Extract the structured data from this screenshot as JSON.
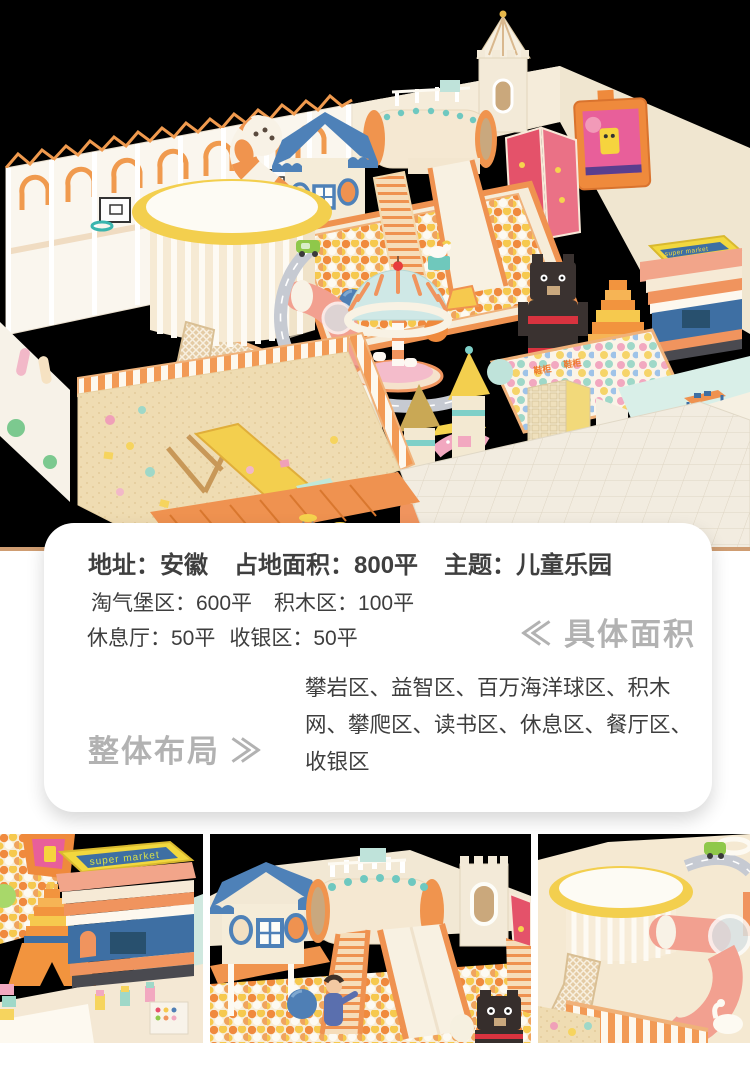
{
  "scene": {
    "background": "#000000",
    "signs": {
      "super_market": "super market",
      "shoe_cabinet_1": "鞋柜",
      "shoe_cabinet_2": "鞋柜",
      "cashier_desk": "收银台"
    },
    "palette": {
      "floor_cream": "#f6e8d0",
      "accent_orange": "#ef9250",
      "ball_orange": "#f08a3e",
      "ball_yellow": "#f6c94e",
      "roof_blue": "#4e81b8",
      "dome_mint": "#cfe8e6",
      "sand_tan": "#efddb4",
      "wall_white": "#f8f3ea",
      "pink": "#f2a8c0",
      "teal": "#7fd0c8",
      "green_decal": "#4db06a",
      "tv_frame": "#ef8a3c"
    }
  },
  "info_card": {
    "summary": [
      "地址：安徽",
      "占地面积：800平",
      "主题：儿童乐园"
    ],
    "details_row1": [
      "淘气堡区：600平",
      "积木区：100平"
    ],
    "details_row2": [
      "休息厅：50平",
      "收银区：50平"
    ],
    "specific_area_heading": "≪ 具体面积",
    "layout_heading": "整体布局 ≫",
    "layout_description": "攀岩区、益智区、百万海洋球区、积木网、攀爬区、读书区、休息区、餐厅区、收银区"
  }
}
